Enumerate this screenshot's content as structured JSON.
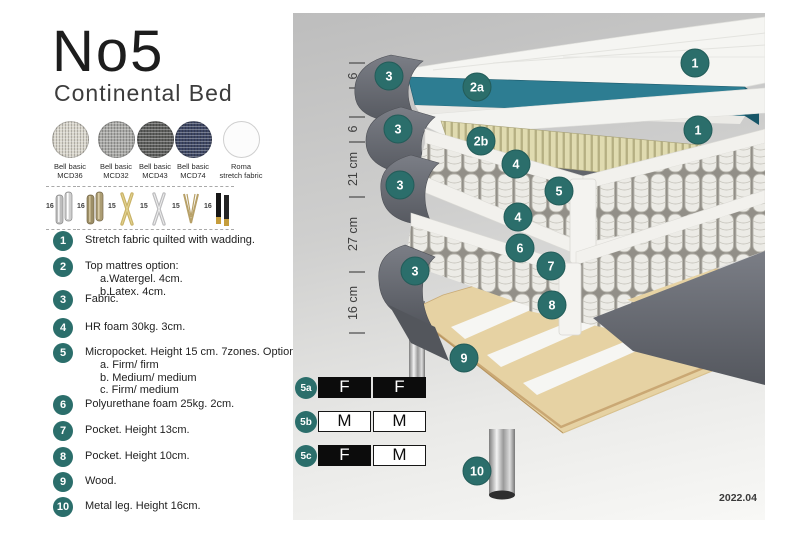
{
  "header": {
    "title": "No5",
    "subtitle": "Continental Bed"
  },
  "fabrics": {
    "swatches": [
      {
        "line1": "Bell basic",
        "line2": "MCD36",
        "color": "#d9d6cc"
      },
      {
        "line1": "Bell basic",
        "line2": "MCD32",
        "color": "#a9a9a6"
      },
      {
        "line1": "Bell basic",
        "line2": "MCD43",
        "color": "#5e5f5d"
      },
      {
        "line1": "Bell basic",
        "line2": "MCD74",
        "color": "#3e4764"
      },
      {
        "line1": "Roma",
        "line2": "stretch fabric",
        "color": "#fcfcfc"
      }
    ]
  },
  "legs": {
    "options": [
      {
        "height": "16",
        "style": "cylinder-silver"
      },
      {
        "height": "16",
        "style": "cylinder-bronze"
      },
      {
        "height": "15",
        "style": "cross-gold"
      },
      {
        "height": "15",
        "style": "cross-silver"
      },
      {
        "height": "15",
        "style": "hairpin-gold"
      },
      {
        "height": "16",
        "style": "block-black-gold"
      }
    ]
  },
  "spec_list": {
    "items": [
      {
        "num": "1",
        "text": "Stretch fabric quilted with wadding."
      },
      {
        "num": "2",
        "text": "Top mattres option:",
        "sub": [
          "a.Watergel. 4cm.",
          "b.Latex. 4cm."
        ]
      },
      {
        "num": "3",
        "text": "Fabric."
      },
      {
        "num": "4",
        "text": "HR foam 30kg. 3cm."
      },
      {
        "num": "5",
        "text": "Micropocket. Height 15 cm. 7zones. Option:",
        "sub": [
          "a. Firm/ firm",
          "b. Medium/ medium",
          "c. Firm/ medium"
        ]
      },
      {
        "num": "6",
        "text": "Polyurethane foam 25kg. 2cm."
      },
      {
        "num": "7",
        "text": "Pocket. Height 13cm."
      },
      {
        "num": "8",
        "text": "Pocket. Height 10cm."
      },
      {
        "num": "9",
        "text": "Wood."
      },
      {
        "num": "10",
        "text": "Metal leg. Height 16cm."
      }
    ]
  },
  "diagram": {
    "ruler": {
      "labels": [
        "6",
        "6",
        "21 cm",
        "27 cm",
        "16 cm"
      ]
    },
    "callouts": [
      {
        "label": "1"
      },
      {
        "label": "3"
      },
      {
        "label": "2a"
      },
      {
        "label": "3"
      },
      {
        "label": "2b"
      },
      {
        "label": "1"
      },
      {
        "label": "4"
      },
      {
        "label": "5"
      },
      {
        "label": "3"
      },
      {
        "label": "4"
      },
      {
        "label": "6"
      },
      {
        "label": "3"
      },
      {
        "label": "7"
      },
      {
        "label": "8"
      },
      {
        "label": "9"
      },
      {
        "label": "10"
      }
    ],
    "firmness_table": {
      "rows": [
        {
          "id": "5a",
          "cells": [
            {
              "letter": "F",
              "filled": true
            },
            {
              "letter": "F",
              "filled": true
            }
          ]
        },
        {
          "id": "5b",
          "cells": [
            {
              "letter": "M",
              "filled": false
            },
            {
              "letter": "M",
              "filled": false
            }
          ]
        },
        {
          "id": "5c",
          "cells": [
            {
              "letter": "F",
              "filled": true
            },
            {
              "letter": "M",
              "filled": false
            }
          ]
        }
      ]
    },
    "version": "2022.04"
  },
  "colors": {
    "accent_teal": "#2b6e6b",
    "watergel_teal": "#2d7d92",
    "latex_cream": "#e0dbb0",
    "fabric_gray": "#686b72",
    "wood": "#e6d2a3"
  }
}
